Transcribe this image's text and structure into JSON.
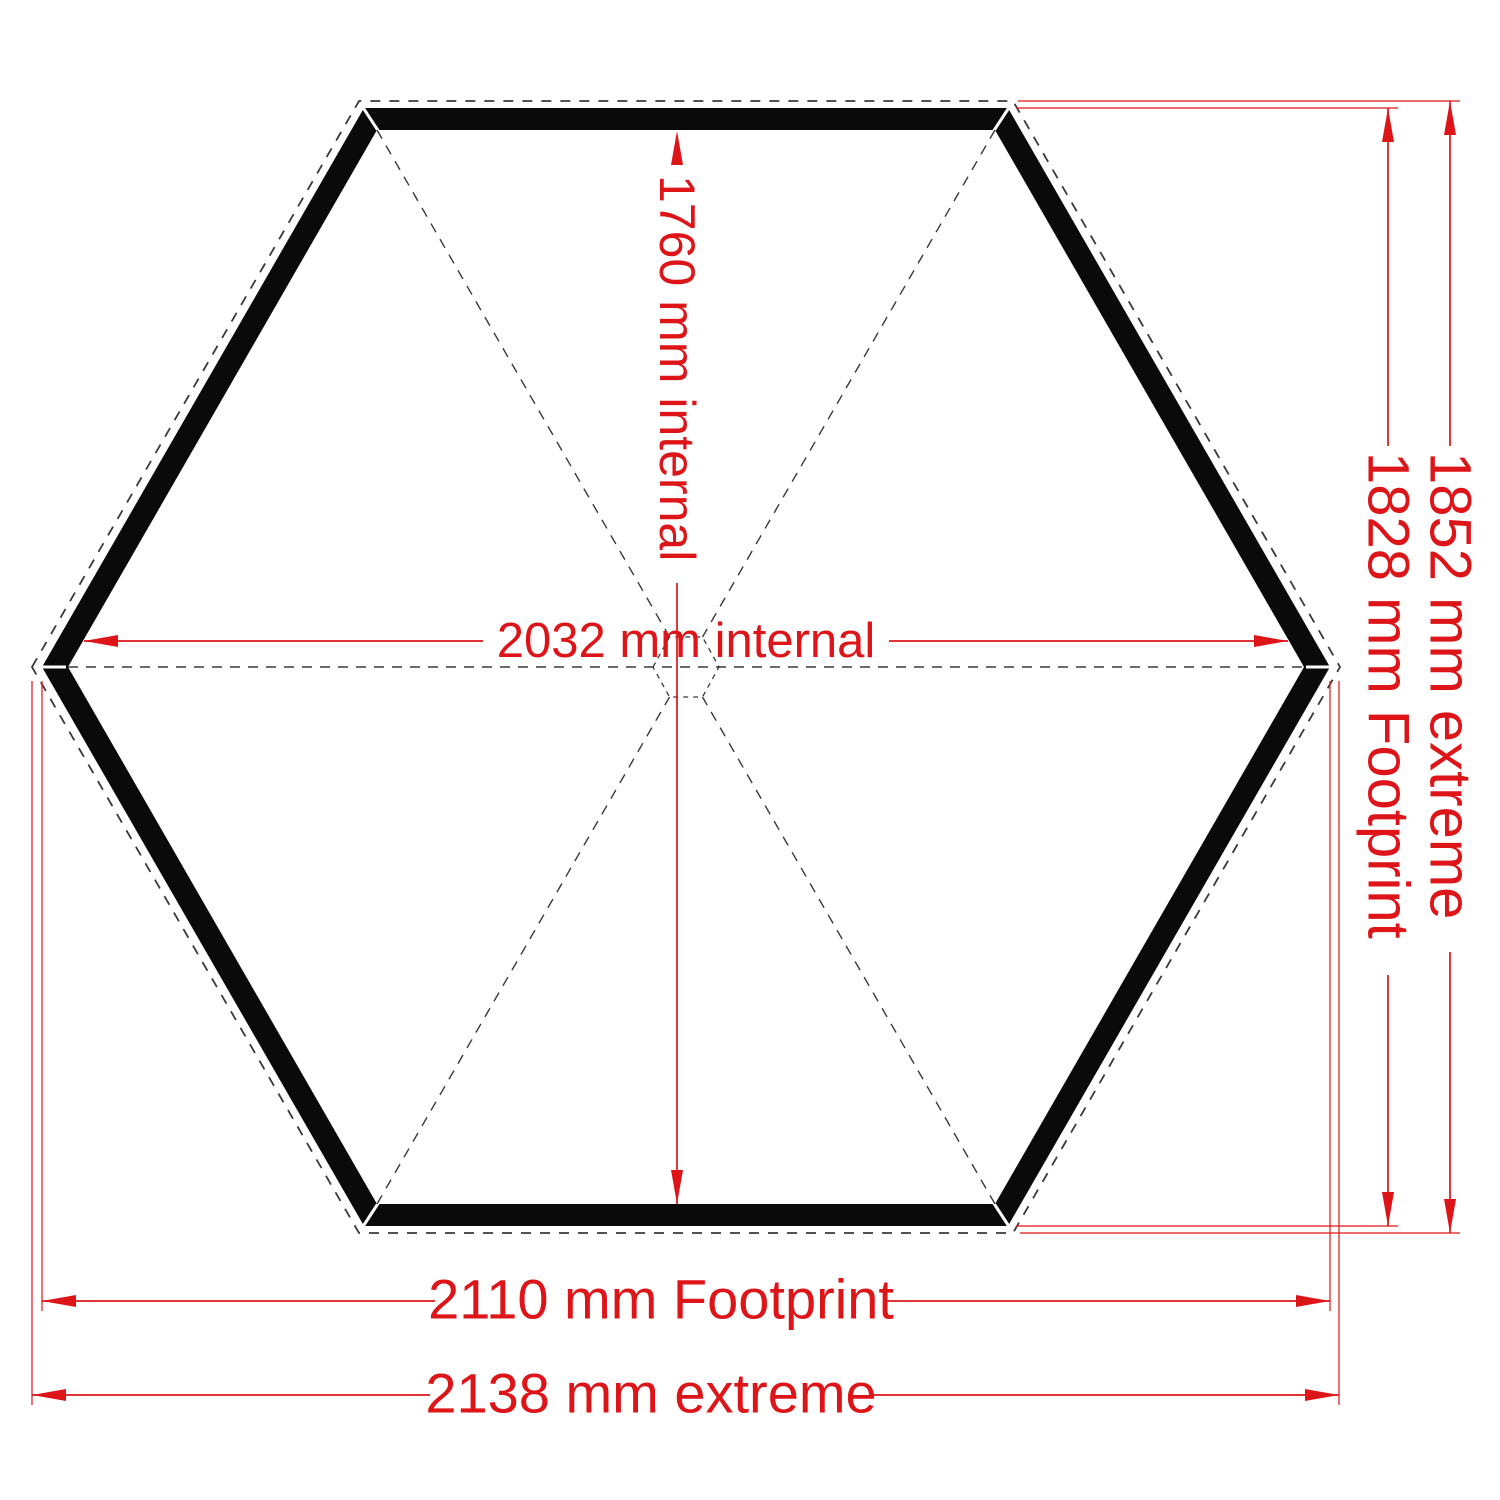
{
  "diagram": {
    "title": "hexagonal-gazebo-floor-plan",
    "labels": {
      "internal_height": "1760 mm internal",
      "internal_width": "2032 mm internal",
      "footprint_width": "2110 mm Footprint",
      "extreme_width": "2138 mm extreme",
      "extreme_height": "1852 mm extreme",
      "footprint_height": "1828 mm Footprint"
    },
    "dimensions_mm": {
      "internal_width": 2032,
      "internal_height": 1760,
      "footprint_width": 2110,
      "footprint_height": 1828,
      "extreme_width": 2138,
      "extreme_height": 1852
    },
    "colors": {
      "dimension": "#dd1519",
      "wall": "#0a0a0a",
      "dash": "#3a3a3a",
      "background": "#ffffff"
    }
  }
}
